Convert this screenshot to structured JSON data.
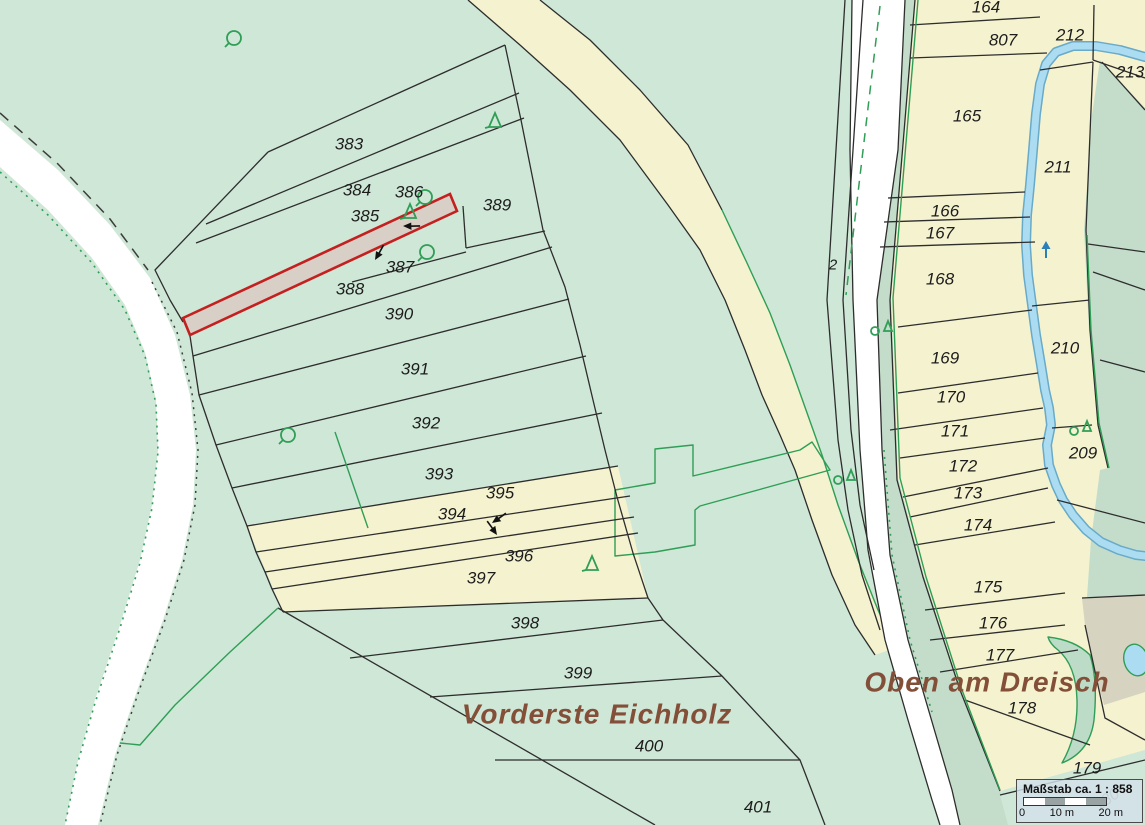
{
  "map": {
    "colors": {
      "bg": "#cfe7d6",
      "yel": "#f5f2cf",
      "dkg": "#c3ddca",
      "stream": "#abdcf2",
      "hls": "#c42020",
      "hlf": "#d8cfc6",
      "bnd": "#2d2d2d",
      "veg": "#2f9e57",
      "lbl": "#1c1c1c",
      "place": "#844f38"
    },
    "parcel_labels": [
      {
        "t": "383",
        "x": 349,
        "y": 144
      },
      {
        "t": "384",
        "x": 357,
        "y": 190
      },
      {
        "t": "385",
        "x": 365,
        "y": 216
      },
      {
        "t": "386",
        "x": 409,
        "y": 192
      },
      {
        "t": "387",
        "x": 400,
        "y": 267
      },
      {
        "t": "388",
        "x": 350,
        "y": 289
      },
      {
        "t": "389",
        "x": 497,
        "y": 205
      },
      {
        "t": "390",
        "x": 399,
        "y": 314
      },
      {
        "t": "391",
        "x": 415,
        "y": 369
      },
      {
        "t": "392",
        "x": 426,
        "y": 423
      },
      {
        "t": "393",
        "x": 439,
        "y": 474
      },
      {
        "t": "394",
        "x": 452,
        "y": 514
      },
      {
        "t": "395",
        "x": 500,
        "y": 493
      },
      {
        "t": "396",
        "x": 519,
        "y": 556
      },
      {
        "t": "397",
        "x": 481,
        "y": 578
      },
      {
        "t": "398",
        "x": 525,
        "y": 623
      },
      {
        "t": "399",
        "x": 578,
        "y": 673
      },
      {
        "t": "400",
        "x": 649,
        "y": 746
      },
      {
        "t": "401",
        "x": 758,
        "y": 807
      },
      {
        "t": "164",
        "x": 986,
        "y": 7
      },
      {
        "t": "807",
        "x": 1003,
        "y": 40
      },
      {
        "t": "212",
        "x": 1070,
        "y": 35
      },
      {
        "t": "213",
        "x": 1130,
        "y": 72
      },
      {
        "t": "165",
        "x": 967,
        "y": 116
      },
      {
        "t": "211",
        "x": 1058,
        "y": 167
      },
      {
        "t": "166",
        "x": 945,
        "y": 211
      },
      {
        "t": "167",
        "x": 940,
        "y": 233
      },
      {
        "t": "168",
        "x": 940,
        "y": 279
      },
      {
        "t": "169",
        "x": 945,
        "y": 358
      },
      {
        "t": "170",
        "x": 951,
        "y": 397
      },
      {
        "t": "171",
        "x": 955,
        "y": 431
      },
      {
        "t": "172",
        "x": 963,
        "y": 466
      },
      {
        "t": "173",
        "x": 968,
        "y": 493
      },
      {
        "t": "174",
        "x": 978,
        "y": 525
      },
      {
        "t": "210",
        "x": 1065,
        "y": 348
      },
      {
        "t": "209",
        "x": 1083,
        "y": 453
      },
      {
        "t": "175",
        "x": 988,
        "y": 587
      },
      {
        "t": "176",
        "x": 993,
        "y": 623
      },
      {
        "t": "177",
        "x": 1000,
        "y": 655
      },
      {
        "t": "178",
        "x": 1022,
        "y": 708
      },
      {
        "t": "179",
        "x": 1087,
        "y": 768
      },
      {
        "t": "2",
        "x": 833,
        "y": 265,
        "small": true
      }
    ],
    "ghost_label": {
      "t": "180",
      "x": 1107,
      "y": 800,
      "rot": -35
    },
    "place_names": [
      {
        "t": "Vorderste Eichholz",
        "x": 597,
        "y": 714
      },
      {
        "t": "Oben am Dreisch",
        "x": 987,
        "y": 682
      }
    ],
    "symbols": [
      {
        "k": "tree",
        "x": 234,
        "y": 38
      },
      {
        "k": "tree",
        "x": 425,
        "y": 197
      },
      {
        "k": "tree",
        "x": 427,
        "y": 252
      },
      {
        "k": "tree",
        "x": 288,
        "y": 435
      },
      {
        "k": "conifer",
        "x": 495,
        "y": 122
      },
      {
        "k": "conifer",
        "x": 410,
        "y": 213
      },
      {
        "k": "conifer",
        "x": 592,
        "y": 565
      },
      {
        "k": "pair",
        "x": 882,
        "y": 328
      },
      {
        "k": "pair",
        "x": 845,
        "y": 477
      },
      {
        "k": "pair",
        "x": 1081,
        "y": 428
      }
    ],
    "arrows": [
      {
        "x": 403,
        "y": 226,
        "rot": 40
      },
      {
        "x": 375,
        "y": 260,
        "rot": -20
      },
      {
        "x": 492,
        "y": 523,
        "rot": 5
      },
      {
        "x": 497,
        "y": 535,
        "rot": -85
      }
    ],
    "flow_arrow": {
      "x": 1046,
      "y": 250
    },
    "scalebox": {
      "title": "Maßstab ca. 1 : 858",
      "tick0": "0",
      "tick1": "10 m",
      "tick2": "20 m"
    }
  }
}
